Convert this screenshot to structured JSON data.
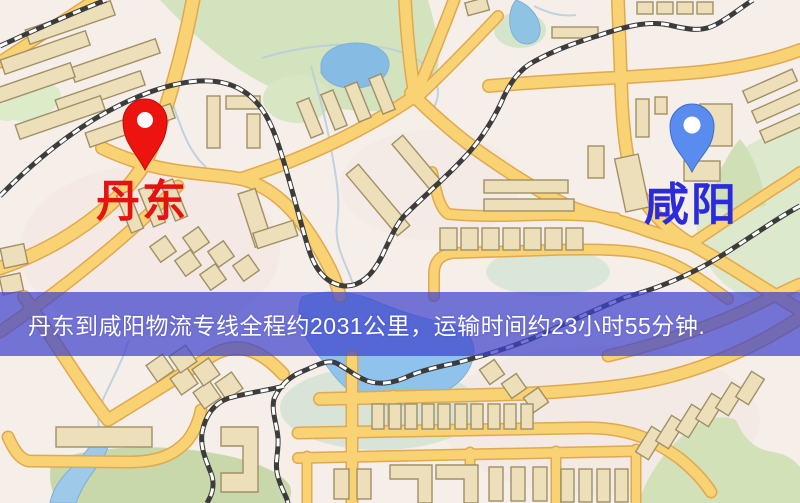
{
  "map": {
    "origin": {
      "name": "丹东",
      "pin_color": "#ed1410",
      "label_color": "#e51210"
    },
    "destination": {
      "name": "咸阳",
      "pin_color": "#5a8bef",
      "label_color": "#2b2bdb"
    },
    "banner": {
      "text": "丹东到咸阳物流专线全程约2031公里，运输时间约23小时55分钟.",
      "background": "#3f42cc",
      "text_color": "#ffffff"
    },
    "route_facts": {
      "distance_text": "约2031公里",
      "duration_text": "约23小时55分钟"
    },
    "palette": {
      "background": "#f6efe9",
      "road_fill": "#f8d273",
      "road_casing": "#e2a84f",
      "water": "#8fc3ec",
      "park": "#d3e3bd",
      "building": "#ecdfb9",
      "railway": "#3c3c3c"
    }
  }
}
